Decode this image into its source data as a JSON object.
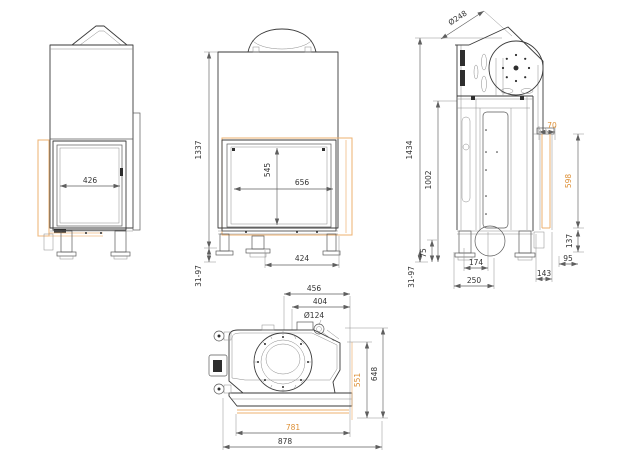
{
  "meta": {
    "drawing_type": "fireplace insert dimensional drawing, four orthographic views",
    "units": "mm",
    "colors": {
      "line": "#3a3a3a",
      "dimension": "#5f5f5f",
      "accent_text": "#dd8f35",
      "accent_line": "#edb06f",
      "background": "#ffffff"
    }
  },
  "views": {
    "side_left": {
      "dims": {
        "opening_width": "426"
      }
    },
    "front": {
      "dims": {
        "overall_height": "1337",
        "glass_height": "545",
        "glass_width": "656",
        "base_width": "424",
        "leveling_range": "31-97"
      }
    },
    "side_right": {
      "dims": {
        "flue_diameter": "Ø248",
        "max_height": "1434",
        "body_height": "1002",
        "leveling_range": "31-97",
        "base_height": "75",
        "flue_center_depth": "174",
        "base_depth": "250",
        "rear_offset": "143",
        "side_offset": "95",
        "frame_bottom": "137",
        "frame_height": "598",
        "frame_top_depth": "70"
      }
    },
    "top": {
      "dims": {
        "flue_offset": "456",
        "air_inlet_offset": "404",
        "air_inlet_diameter": "Ø124",
        "total_depth": "648",
        "frame_depth": "551",
        "frame_width": "781",
        "total_width": "878"
      }
    }
  }
}
